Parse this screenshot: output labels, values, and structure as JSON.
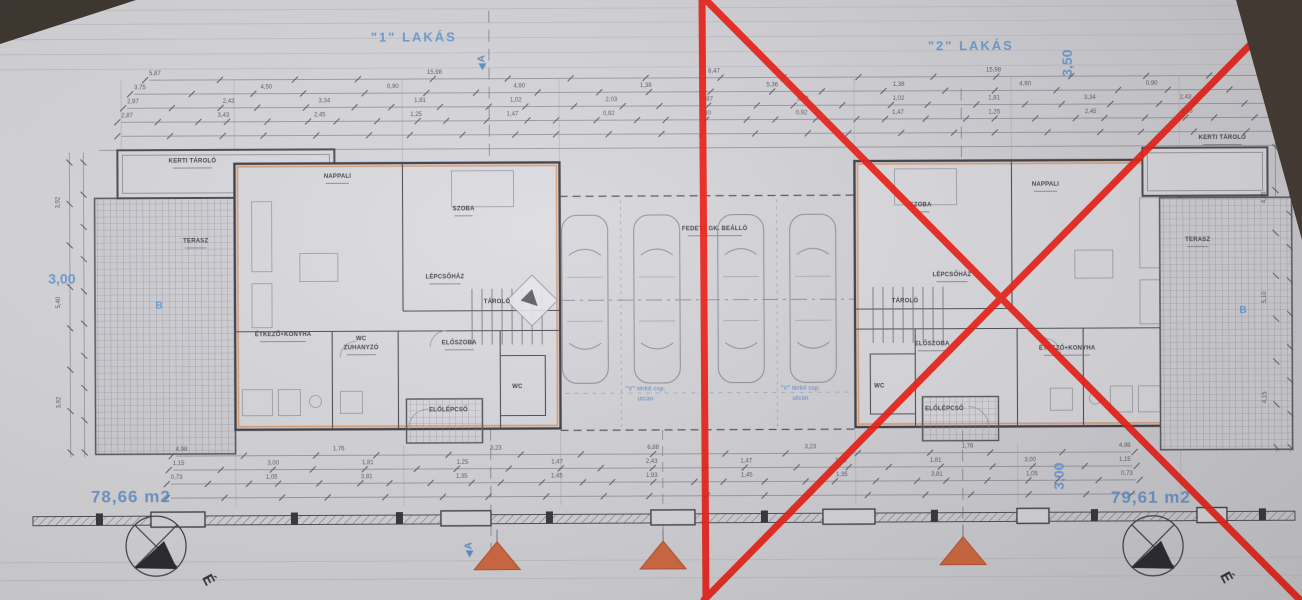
{
  "photo": {
    "background": "#3a332c",
    "paper": "#d9d9de",
    "red": "#ee1c13",
    "blue": "#5d8fcb",
    "orange": "#d4693e"
  },
  "titles": {
    "apartment1": "\"1\" LAKÁS",
    "apartment2": "\"2\" LAKÁS"
  },
  "areas": {
    "apartment1": "78,66 m2",
    "apartment2": "79,61 m2"
  },
  "blue_dimensions": {
    "top_right": "3,50",
    "left": "3,00",
    "bottom_right": "3,00"
  },
  "markers": {
    "section": "A",
    "terrace": "B",
    "north": "É"
  },
  "room_labels": {
    "kerti_tarolo": "KERTI TÁROLÓ",
    "terasz": "TERASZ",
    "nappali": "NAPPALI",
    "szoba": "SZOBA",
    "lepcsohaz": "LÉPCSŐHÁZ",
    "tarolo": "TÁROLÓ",
    "etkezo_konyha": "ÉTKEZŐ+KONYHA",
    "wc": "WC",
    "zuhanyzo": "ZUHANYZÓ",
    "eloszoba": "ELŐSZOBA",
    "elolepcso": "ELŐLÉPCSŐ",
    "carport": "FEDETT GK. BEÁLLÓ"
  },
  "site_note": {
    "line1": "\"V\" térkő csp.",
    "line2": "utcán"
  },
  "dimensions": {
    "top_rows": [
      [
        "5,87",
        "15,98",
        "6,47",
        "15,98",
        "5,10"
      ],
      [
        "3,75",
        "4,50",
        "0,90",
        "4,90",
        "1,38",
        "5,36",
        "1,38",
        "4,90",
        "0,90",
        "3,50"
      ],
      [
        "2,97",
        "2,43",
        "3,34",
        "1,81",
        "1,02",
        "2,03",
        "6,87",
        "2,03",
        "1,02",
        "1,81",
        "3,34",
        "2,43",
        "4,15"
      ],
      [
        "2,87",
        "3,43",
        "2,45",
        "1,25",
        "1,47",
        "0,92",
        "5,80",
        "0,92",
        "1,47",
        "1,25",
        "2,45",
        "3,43",
        "1,10"
      ]
    ],
    "bottom_rows": [
      [
        "4,98",
        "1,76",
        "3,23",
        "6,88",
        "3,23",
        "1,76",
        "4,98"
      ],
      [
        "1,15",
        "3,00",
        "1,81",
        "1,25",
        "1,47",
        "2,43",
        "1,47",
        "1,25",
        "1,81",
        "3,00",
        "1,15"
      ],
      [
        "0,73",
        "1,05",
        "3,81",
        "1,35",
        "1,45",
        "1,93",
        "1,45",
        "1,35",
        "3,81",
        "1,05",
        "0,73"
      ]
    ],
    "left_column": [
      "3,92",
      "5,40",
      "3,92"
    ],
    "right_column": [
      "4,15",
      "5,10",
      "4,15"
    ]
  }
}
